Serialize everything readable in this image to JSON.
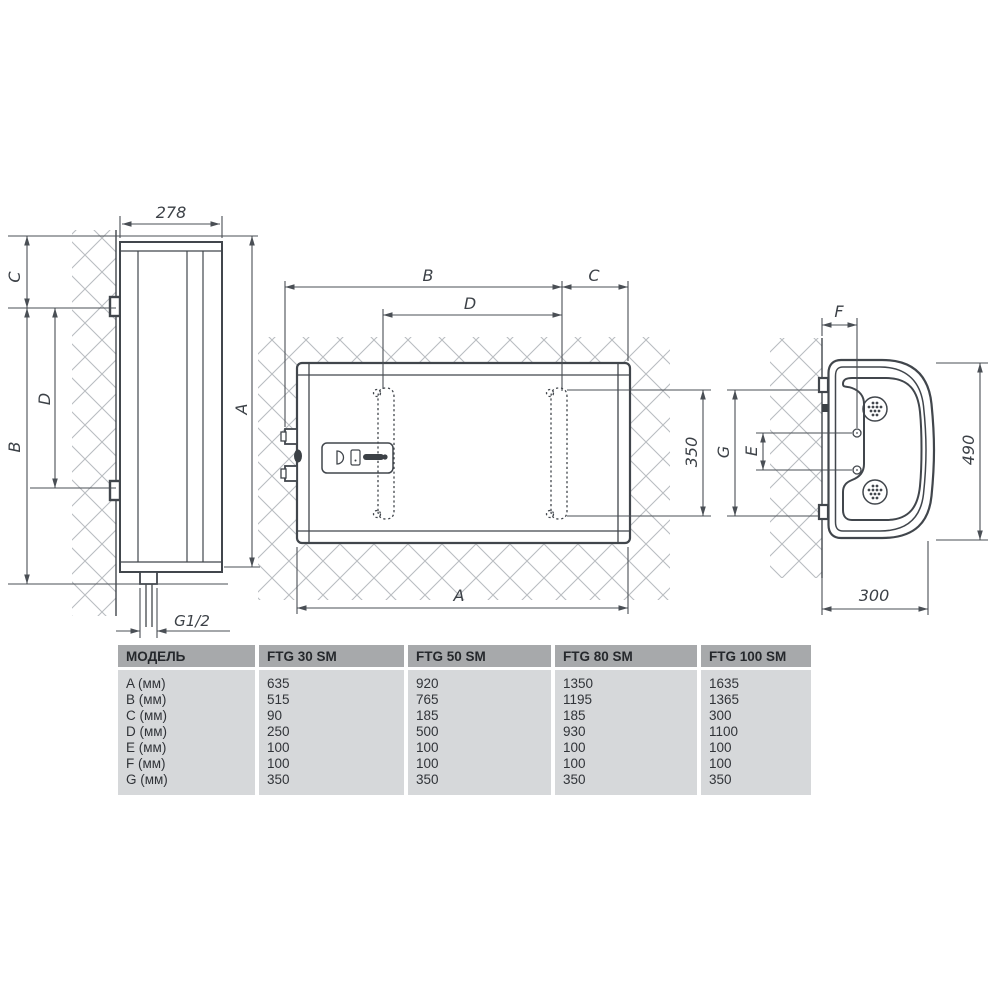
{
  "drawing": {
    "dims": {
      "width_278": "278",
      "a": "A",
      "b": "B",
      "c": "C",
      "d": "D",
      "e": "E",
      "f": "F",
      "g": "G",
      "depth_350": "350",
      "height_490": "490",
      "depth_300": "300",
      "pipe_thread": "G1/2"
    }
  },
  "table": {
    "columns": [
      "МОДЕЛЬ",
      "FTG 30 SM",
      "FTG 50 SM",
      "FTG 80 SM",
      "FTG 100 SM"
    ],
    "rows": [
      {
        "label": "A (мм)",
        "values": [
          "635",
          "920",
          "1350",
          "1635"
        ]
      },
      {
        "label": "B (мм)",
        "values": [
          "515",
          "765",
          "1195",
          "1365"
        ]
      },
      {
        "label": "C (мм)",
        "values": [
          "90",
          "185",
          "185",
          "300"
        ]
      },
      {
        "label": "D (мм)",
        "values": [
          "250",
          "500",
          "930",
          "1100"
        ]
      },
      {
        "label": "E (мм)",
        "values": [
          "100",
          "100",
          "100",
          "100"
        ]
      },
      {
        "label": "F (мм)",
        "values": [
          "100",
          "100",
          "100",
          "100"
        ]
      },
      {
        "label": "G (мм)",
        "values": [
          "350",
          "350",
          "350",
          "350"
        ]
      }
    ]
  },
  "colors": {
    "line": "#41464c",
    "dim_line": "#4a4f55",
    "hatch": "#b9bdc1",
    "table_header_bg": "#a7a9ab",
    "table_body_bg": "#d6d8da"
  }
}
